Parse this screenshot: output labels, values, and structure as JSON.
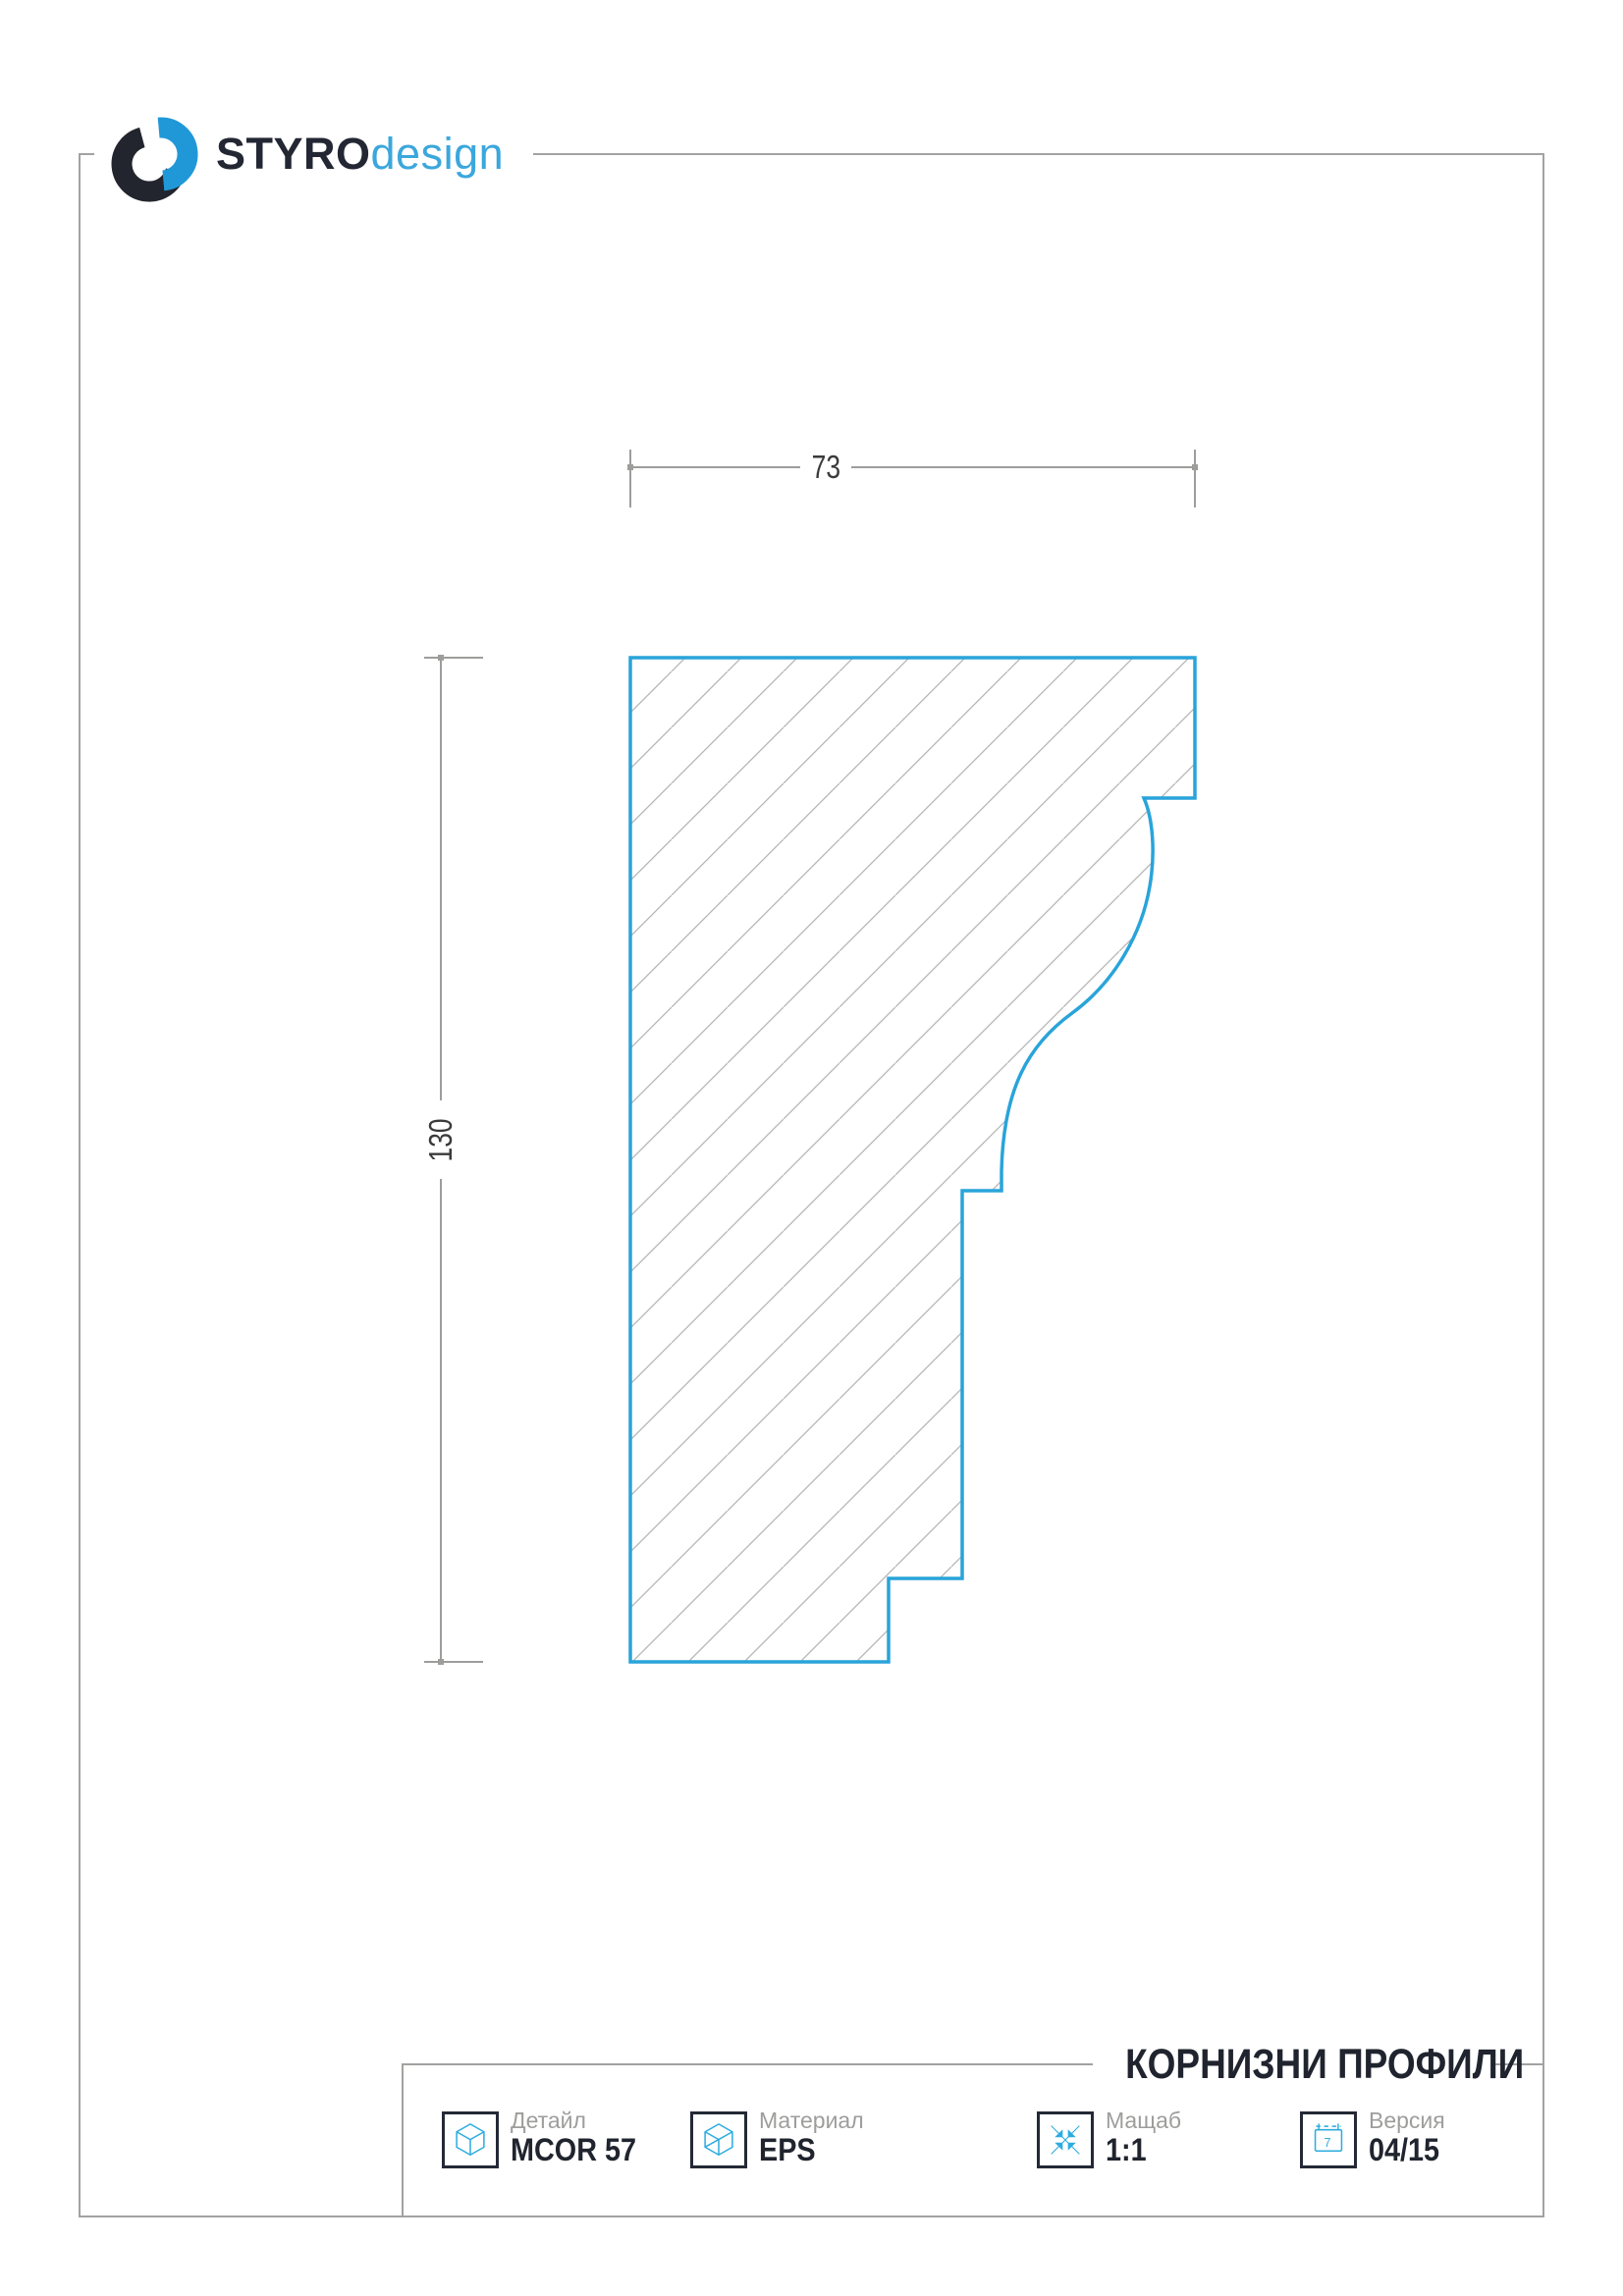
{
  "brand": {
    "name_bold": "STYRO",
    "name_light": "design"
  },
  "drawing": {
    "type": "cornice-profile-cross-section",
    "width_dim_label": "73",
    "height_dim_label": "130",
    "width_mm": 73,
    "height_mm": 130
  },
  "footer": {
    "section_title": "КОРНИЗНИ ПРОФИЛИ",
    "fields": [
      {
        "label": "Детайл",
        "value": "MCOR 57",
        "icon": "cube-icon"
      },
      {
        "label": "Материал",
        "value": "EPS",
        "icon": "material-cube-icon"
      },
      {
        "label": "Мащаб",
        "value": "1:1",
        "icon": "scale-arrows-icon"
      },
      {
        "label": "Версия",
        "value": "04/15",
        "icon": "calendar-icon"
      }
    ],
    "calendar_digit": "7"
  },
  "colors": {
    "accent_cyan": "#29a4da",
    "icon_cyan": "#2cacdf",
    "logo_dark": "#23252e",
    "logo_blue": "#2098d8",
    "text_dark": "#20242e",
    "muted_gray": "#9d9d9c",
    "frame_gray": "#a2a2a1",
    "hatch_gray": "#b5b5b5"
  }
}
